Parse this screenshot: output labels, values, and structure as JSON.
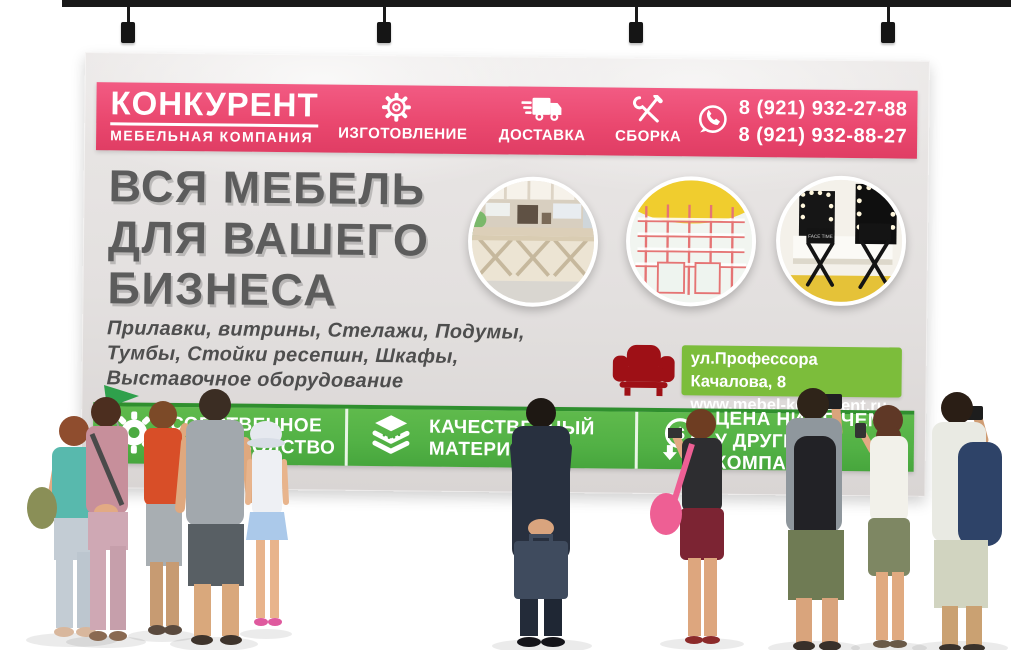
{
  "banner": {
    "header": {
      "logo": {
        "title": "КОНКУРЕНТ",
        "subtitle": "МЕБЕЛЬНАЯ КОМПАНИЯ"
      },
      "services": [
        {
          "icon": "gear-icon",
          "label": "ИЗГОТОВЛЕНИЕ"
        },
        {
          "icon": "truck-icon",
          "label": "ДОСТАВКА"
        },
        {
          "icon": "tools-icon",
          "label": "СБОРКА"
        }
      ],
      "whatsapp_icon": "whatsapp-icon",
      "phones": [
        "8 (921) 932-27-88",
        "8 (921) 932-88-27"
      ]
    },
    "headline": [
      "ВСЯ МЕБЕЛЬ",
      "ДЛЯ ВАШЕГО",
      "БИЗНЕСА"
    ],
    "subtitle": [
      "Прилавки, витрины, Стелажи, Подумы,",
      "Тумбы, Стойки ресепшн, Шкафы,",
      "Выставочное оборудование"
    ],
    "photos": [
      {
        "name": "retail-counter-photo"
      },
      {
        "name": "shelving-racks-photo"
      },
      {
        "name": "makeup-studio-photo",
        "chair_label": "FACE TIME"
      }
    ],
    "address": {
      "armchair_icon": "armchair-icon",
      "line1": "ул.Профессора Качалова, 8",
      "line2": "www.mebel-konkurent.ru"
    },
    "footer": {
      "badges": [
        {
          "icon": "gear-badge-icon",
          "line1": "СОБСТВЕННОЕ",
          "line2": "ПРОИЗВОДСТВО"
        },
        {
          "icon": "layers-icon",
          "line1": "КАЧЕСТВЕННЫЙ",
          "line2": "МАТЕРИАЛ"
        },
        {
          "icon": "price-down-icon",
          "line1": "ЦЕНА НИЖЕ ЧЕМ",
          "line2": "У ДРУГИХ КОМПАНИЙ"
        }
      ]
    },
    "colors": {
      "pink": "#ea486f",
      "banner_gray": "#e3e0df",
      "headline_gray": "#5c5c5c",
      "footer_green": "#52b145",
      "address_green": "#7cbd3b",
      "armchair_red": "#9e1016"
    }
  },
  "people": [
    "woman-teal-top-with-camera",
    "woman-pink-outfit",
    "person-orange-tank",
    "man-gray-shirt",
    "child-white-hat",
    "businessman-with-briefcase",
    "woman-black-top-pink-bag",
    "man-black-backpack-camera",
    "woman-white-top-phone",
    "man-blue-backpack-camera"
  ]
}
